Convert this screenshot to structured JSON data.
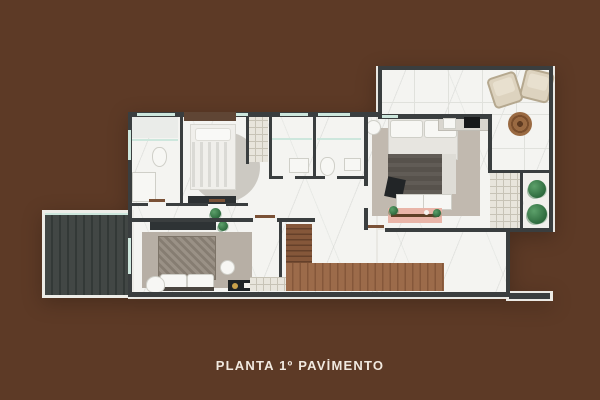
{
  "title": {
    "text": "PLANTA 1º PAVİMENTO"
  },
  "colors": {
    "bg": "#5d3a26",
    "wall": "#3a3e3f",
    "floor": "#f4f4f1",
    "window": "#cde7dd",
    "wood": "#9c6b4a",
    "woodDark": "#85573a",
    "plant": "#2e6b3e",
    "deskPink": "#e9b5a8",
    "caption": "#f1e9e0"
  }
}
